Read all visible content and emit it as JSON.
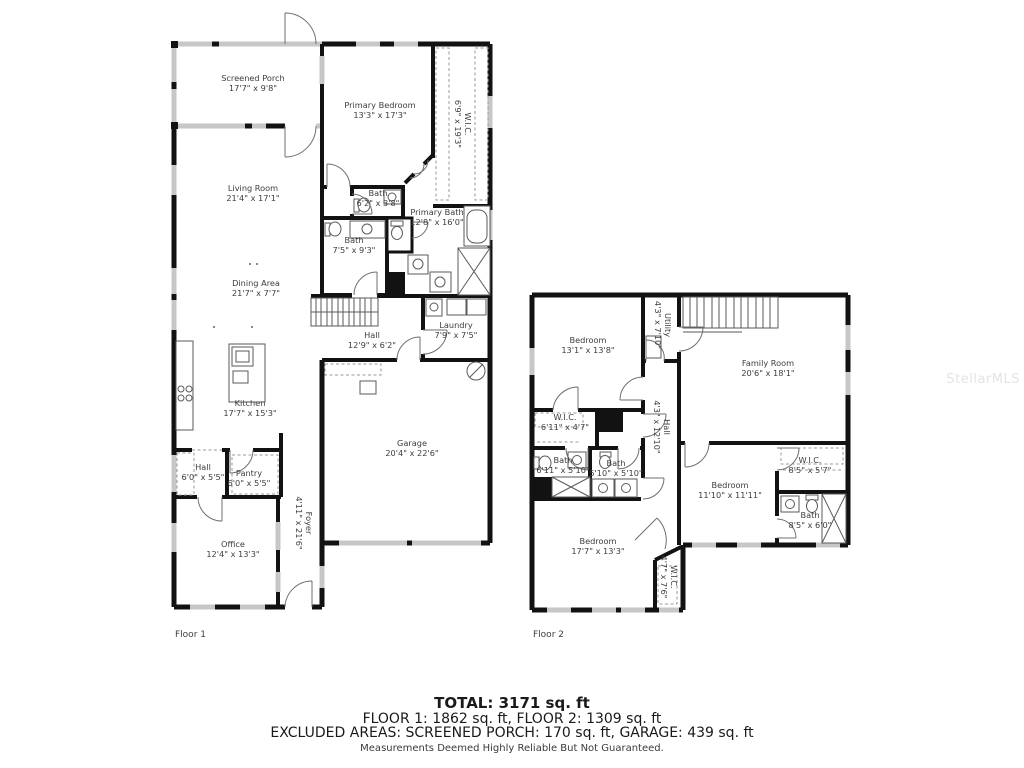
{
  "watermark": "StellarMLS",
  "floor1": {
    "label": "Floor 1",
    "rooms": {
      "screened_porch": {
        "name": "Screened Porch",
        "dims": "17'7\" x 9'8\""
      },
      "primary_bedroom": {
        "name": "Primary Bedroom",
        "dims": "13'3\" x 17'3\""
      },
      "wic": {
        "name": "W.I.C.",
        "dims": "6'9\" x 19'3\""
      },
      "living_room": {
        "name": "Living Room",
        "dims": "21'4\" x 17'1\""
      },
      "bath_a": {
        "name": "Bath",
        "dims": "6'2\" x 3'8\""
      },
      "primary_bath": {
        "name": "Primary Bath",
        "dims": "12'8\" x 16'0\""
      },
      "bath_b": {
        "name": "Bath",
        "dims": "7'5\" x 9'3\""
      },
      "dining_area": {
        "name": "Dining Area",
        "dims": "21'7\" x 7'7\""
      },
      "hall_a": {
        "name": "Hall",
        "dims": "12'9\" x 6'2\""
      },
      "laundry": {
        "name": "Laundry",
        "dims": "7'9\" x 7'5\""
      },
      "kitchen": {
        "name": "Kitchen",
        "dims": "17'7\" x 15'3\""
      },
      "garage": {
        "name": "Garage",
        "dims": "20'4\" x 22'6\""
      },
      "hall_b": {
        "name": "Hall",
        "dims": "6'0\" x 5'5\""
      },
      "pantry": {
        "name": "Pantry",
        "dims": "6'0\" x 5'5\""
      },
      "office": {
        "name": "Office",
        "dims": "12'4\" x 13'3\""
      },
      "foyer": {
        "name": "Foyer",
        "dims": "4'11\" x 21'6\""
      }
    }
  },
  "floor2": {
    "label": "Floor 2",
    "rooms": {
      "bedroom_a": {
        "name": "Bedroom",
        "dims": "13'1\" x 13'8\""
      },
      "utility": {
        "name": "Utility",
        "dims": "4'3\" x 7'10\""
      },
      "family_room": {
        "name": "Family Room",
        "dims": "20'6\" x 18'1\""
      },
      "wic_a": {
        "name": "W.I.C.",
        "dims": "6'11\" x 4'7\""
      },
      "hall": {
        "name": "Hall",
        "dims": "4'3\" x 12'10\""
      },
      "bath_a": {
        "name": "Bath",
        "dims": "6'11\" x 5'10\""
      },
      "bath_b": {
        "name": "Bath",
        "dims": "5'10\" x 5'10\""
      },
      "bedroom_b": {
        "name": "Bedroom",
        "dims": "11'10\" x 11'11\""
      },
      "wic_b": {
        "name": "W.I.C.",
        "dims": "8'5\" x 5'7\""
      },
      "bath_c": {
        "name": "Bath",
        "dims": "8'5\" x 6'0\""
      },
      "bedroom_c": {
        "name": "Bedroom",
        "dims": "17'7\" x 13'3\""
      },
      "wic_c": {
        "name": "W.I.C.",
        "dims": "4'7\" x 7'6\""
      }
    }
  },
  "summary": {
    "total": "TOTAL: 3171 sq. ft",
    "floors": "FLOOR 1: 1862 sq. ft, FLOOR 2: 1309 sq. ft",
    "excluded": "EXCLUDED AREAS: SCREENED PORCH: 170 sq. ft, GARAGE: 439 sq. ft",
    "disclaimer": "Measurements Deemed Highly Reliable But Not Guaranteed."
  }
}
